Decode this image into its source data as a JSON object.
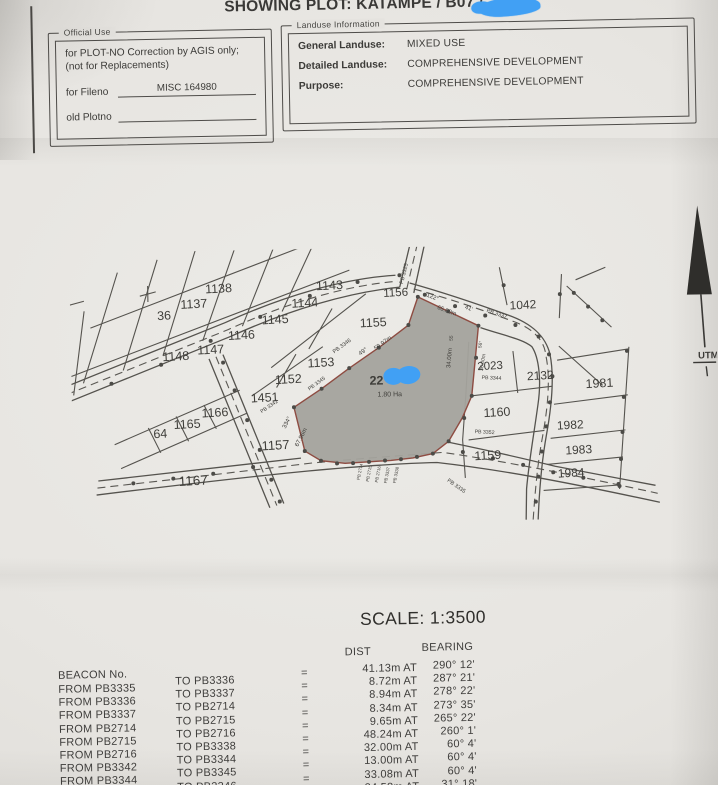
{
  "title": "SHOWING PLOT:  KATAMPE / B07 /",
  "official_use": {
    "legend": "Official Use",
    "line1": "for PLOT-NO Correction by AGIS only;",
    "line2": "(not for Replacements)",
    "fileno_label": "for Fileno",
    "fileno_value": "MISC 164980",
    "old_plotno_label": "old Plotno",
    "old_plotno_value": ""
  },
  "landuse": {
    "legend": "Landuse Information",
    "rows": [
      {
        "label": "General Landuse:",
        "value": "MIXED USE"
      },
      {
        "label": "Detailed Landuse:",
        "value": "COMPREHENSIVE DEVELOPMENT"
      },
      {
        "label": "Purpose:",
        "value": "COMPREHENSIVE DEVELOPMENT"
      }
    ]
  },
  "map": {
    "highlighted_plot": {
      "visible_number": "22",
      "area_label": "1.80 Ha"
    },
    "north_label": "UTM",
    "labels": [
      {
        "t": "36",
        "x": 94,
        "y": 68,
        "s": 12.5,
        "r": -2
      },
      {
        "t": "1137",
        "x": 124,
        "y": 57,
        "s": 12.5,
        "r": -2
      },
      {
        "t": "1138",
        "x": 149,
        "y": 42,
        "s": 12.5,
        "r": -2
      },
      {
        "t": "1143",
        "x": 260,
        "y": 41,
        "s": 12.5,
        "r": -2
      },
      {
        "t": "1144",
        "x": 235,
        "y": 58,
        "s": 12.5,
        "r": -2
      },
      {
        "t": "1145",
        "x": 205,
        "y": 74,
        "s": 12.5,
        "r": -2
      },
      {
        "t": "1146",
        "x": 171,
        "y": 89,
        "s": 12.5,
        "r": -2
      },
      {
        "t": "1147",
        "x": 140,
        "y": 103,
        "s": 12.5,
        "r": -2
      },
      {
        "t": "1148",
        "x": 105,
        "y": 109,
        "s": 12.5,
        "r": -2
      },
      {
        "t": "1156",
        "x": 326,
        "y": 49,
        "s": 11.5,
        "r": -2
      },
      {
        "t": "1155",
        "x": 303,
        "y": 79,
        "s": 12.5,
        "r": -2
      },
      {
        "t": "1153",
        "x": 250,
        "y": 118,
        "s": 12.5,
        "r": -2
      },
      {
        "t": "1152",
        "x": 217,
        "y": 134,
        "s": 12.5,
        "r": -2
      },
      {
        "t": "1451",
        "x": 193,
        "y": 152,
        "s": 12.5,
        "r": -2
      },
      {
        "t": "1166",
        "x": 143,
        "y": 166,
        "s": 12.5,
        "r": -2
      },
      {
        "t": "1165",
        "x": 115,
        "y": 177,
        "s": 12.5,
        "r": -2
      },
      {
        "t": "64",
        "x": 88,
        "y": 186,
        "s": 12.5,
        "r": -2
      },
      {
        "t": "1157",
        "x": 203,
        "y": 200,
        "s": 13,
        "r": -2
      },
      {
        "t": "1167",
        "x": 120,
        "y": 234,
        "s": 13.5,
        "r": -2
      },
      {
        "t": "1042",
        "x": 453,
        "y": 64,
        "s": 12,
        "r": -2
      },
      {
        "t": "2023",
        "x": 419,
        "y": 124,
        "s": 11.5,
        "r": -2
      },
      {
        "t": "2132",
        "x": 469,
        "y": 135,
        "s": 12,
        "r": -2
      },
      {
        "t": "1981",
        "x": 528,
        "y": 144,
        "s": 12.5,
        "r": -2
      },
      {
        "t": "1160",
        "x": 425,
        "y": 171,
        "s": 12.5,
        "r": -2
      },
      {
        "t": "1982",
        "x": 498,
        "y": 185,
        "s": 12,
        "r": -2
      },
      {
        "t": "1159",
        "x": 415,
        "y": 214,
        "s": 12.5,
        "r": -2
      },
      {
        "t": "1983",
        "x": 506,
        "y": 210,
        "s": 12,
        "r": -2
      },
      {
        "t": "1984",
        "x": 498,
        "y": 233,
        "s": 12,
        "r": -2
      },
      {
        "t": "22",
        "x": 305,
        "y": 137,
        "s": 12.5,
        "r": 0,
        "w": 700
      },
      {
        "t": "1.80 Ha",
        "x": 318,
        "y": 149,
        "s": 7,
        "r": 0
      },
      {
        "t": "PB 3325",
        "x": 336,
        "y": 27,
        "s": 5.5,
        "r": -75
      },
      {
        "t": "122°",
        "x": 362,
        "y": 52,
        "s": 6,
        "r": 22
      },
      {
        "t": "41'",
        "x": 398,
        "y": 64,
        "s": 6,
        "r": 22
      },
      {
        "t": "65.00m",
        "x": 376,
        "y": 66,
        "s": 6,
        "r": 22
      },
      {
        "t": "PB 3337",
        "x": 426,
        "y": 70,
        "s": 5.5,
        "r": 20
      },
      {
        "t": "PB 3346",
        "x": 272,
        "y": 99,
        "s": 5.5,
        "r": -35
      },
      {
        "t": "49°",
        "x": 293,
        "y": 105,
        "s": 6,
        "r": -35
      },
      {
        "t": "59.97m",
        "x": 313,
        "y": 97,
        "s": 6,
        "r": -35
      },
      {
        "t": "PB 3345",
        "x": 246,
        "y": 136,
        "s": 5.2,
        "r": -35
      },
      {
        "t": "PB 3342",
        "x": 198,
        "y": 158,
        "s": 5.2,
        "r": -33
      },
      {
        "t": "334°",
        "x": 216,
        "y": 174,
        "s": 6,
        "r": -62
      },
      {
        "t": "67.96m",
        "x": 230,
        "y": 189,
        "s": 6,
        "r": -62
      },
      {
        "t": "34.00m",
        "x": 380,
        "y": 112,
        "s": 6,
        "r": -84
      },
      {
        "t": "55",
        "x": 382,
        "y": 92,
        "s": 4.8,
        "r": -84
      },
      {
        "t": "56°",
        "x": 411,
        "y": 99,
        "s": 4.8,
        "r": -80
      },
      {
        "t": "36.00m",
        "x": 413,
        "y": 117,
        "s": 5.2,
        "r": -80
      },
      {
        "t": "PB 3344",
        "x": 420,
        "y": 134,
        "s": 5.2,
        "r": 4
      },
      {
        "t": "PB 3352",
        "x": 412,
        "y": 188,
        "s": 5.2,
        "r": 4
      },
      {
        "t": "PB 3335",
        "x": 382,
        "y": 241,
        "s": 5.5,
        "r": 36
      },
      {
        "t": "PB 2714",
        "x": 288,
        "y": 224,
        "s": 4.3,
        "r": -78
      },
      {
        "t": "PB 2715",
        "x": 297,
        "y": 226,
        "s": 4.3,
        "r": -78
      },
      {
        "t": "PB 2716",
        "x": 306,
        "y": 227,
        "s": 4.3,
        "r": -78
      },
      {
        "t": "PB 3337",
        "x": 315,
        "y": 228,
        "s": 4.3,
        "r": -78
      },
      {
        "t": "PB 3338",
        "x": 324,
        "y": 228,
        "s": 4.3,
        "r": -78
      }
    ]
  },
  "scale_label": "SCALE: 1:3500",
  "beacon_table": {
    "header_beacon": "BEACON No.",
    "header_dist": "DIST",
    "header_bearing": "BEARING",
    "eq": "=",
    "at_label": "AT",
    "rows": [
      {
        "from": "FROM PB3335",
        "to": "TO PB3336",
        "dist": "41.13m",
        "bearing": "290° 12'"
      },
      {
        "from": "FROM PB3336",
        "to": "TO PB3337",
        "dist": "8.72m",
        "bearing": "287° 21'"
      },
      {
        "from": "FROM PB3337",
        "to": "TO PB2714",
        "dist": "8.94m",
        "bearing": "278° 22'"
      },
      {
        "from": "FROM PB2714",
        "to": "TO PB2715",
        "dist": "8.34m",
        "bearing": "273° 35'"
      },
      {
        "from": "FROM PB2715",
        "to": "TO PB2716",
        "dist": "9.65m",
        "bearing": "265° 22'"
      },
      {
        "from": "FROM PB2716",
        "to": "TO PB3338",
        "dist": "48.24m",
        "bearing": "260° 1'"
      },
      {
        "from": "FROM PB3342",
        "to": "TO PB3344",
        "dist": "32.00m",
        "bearing": "60° 4'"
      },
      {
        "from": "FROM PB3344",
        "to": "TO PB3345",
        "dist": "13.00m",
        "bearing": "60° 4'"
      },
      {
        "from": "FROM PB3345",
        "to": "TO PB3346",
        "dist": "33.08m",
        "bearing": "60° 4'"
      },
      {
        "from": "FROM PB3346",
        "to": "TO PB3325",
        "dist": "34.58m",
        "bearing": "31° 18'"
      }
    ]
  },
  "colors": {
    "paper": "#e7e5e1",
    "ink": "#3e3d3b",
    "map_line": "#55534e",
    "plot_fill": "#a4a39d",
    "plot_border": "#8e4c42",
    "scribble": "#41a0f4"
  }
}
